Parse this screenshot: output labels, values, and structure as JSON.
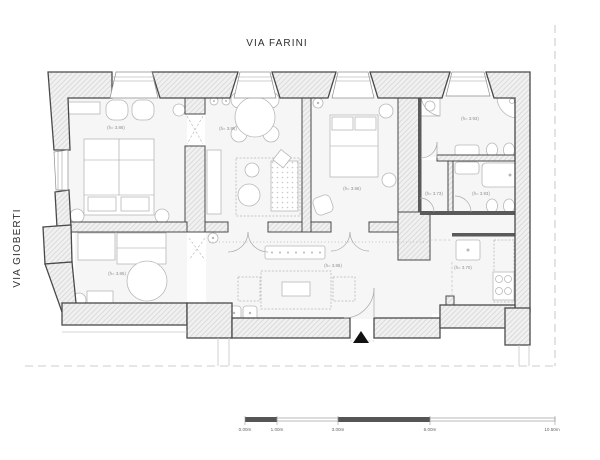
{
  "plan": {
    "streets": {
      "top_label": "VIA FARINI",
      "left_label": "VIA GIOBERTI"
    },
    "rooms": {
      "bedroom_nw": {
        "height_label": "(h= 3.86)"
      },
      "dining_room": {
        "height_label": "(h= 3.86)"
      },
      "bedroom_n": {
        "height_label": "(h= 3.86)"
      },
      "bathroom_ne": {
        "height_label": "(h= 3.93)"
      },
      "anteroom": {
        "height_label": "(h= 3.73)"
      },
      "bathroom_se": {
        "height_label": "(h= 3.93)"
      },
      "bedroom_sw": {
        "height_label": "(h= 3.86)"
      },
      "living_hall": {
        "height_label": "(h= 3.86)"
      },
      "kitchen": {
        "height_label": "(h= 3.70)"
      }
    },
    "scale_bar": {
      "tick_labels": [
        "0.00m",
        "1.00m",
        "3.00m",
        "6.00m",
        "10.50m"
      ]
    },
    "colors": {
      "wall_outline": "#4a4a4a",
      "wall_hatch": "#dadada",
      "floor": "#f6f6f6",
      "furniture": "#b8b8b8",
      "label_text": "#8f8f8f",
      "street_text": "#2f2f2f",
      "boundary_dash": "#cccccc",
      "scale_dark": "#555555",
      "entrance_marker": "#111111"
    }
  }
}
